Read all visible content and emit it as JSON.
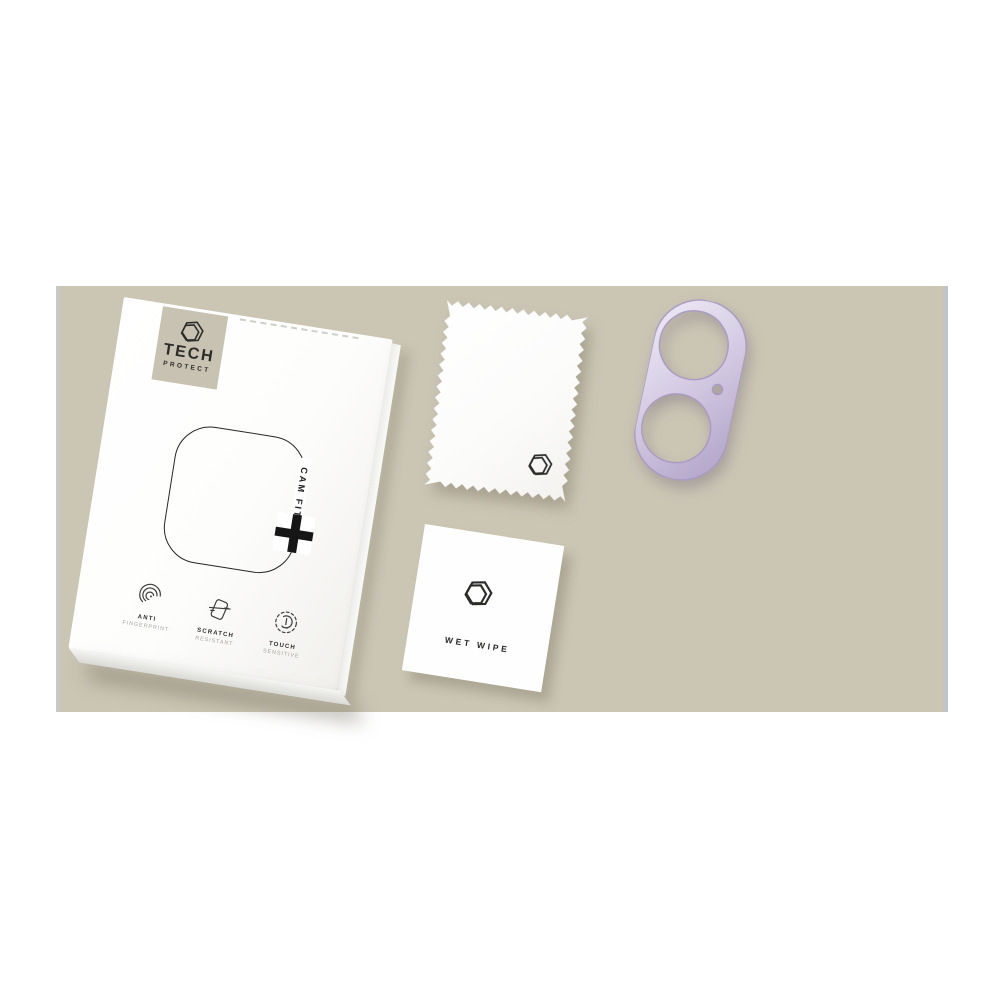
{
  "scene": {
    "page_background": "#ffffff",
    "photo_background": "#cbc5b4",
    "photo_edge_strip": "#c3c4c6"
  },
  "box": {
    "brand_line1": "TECH",
    "brand_line2": "PROTECT",
    "product_label": "CAM FIT",
    "features": [
      {
        "title": "ANTI",
        "subtitle": "FINGERPRINT",
        "icon": "fingerprint-icon"
      },
      {
        "title": "SCRATCH",
        "subtitle": "RESISTANT",
        "icon": "scratch-icon"
      },
      {
        "title": "TOUCH",
        "subtitle": "SENSITIVE",
        "icon": "touch-icon"
      }
    ]
  },
  "cloth": {
    "logo_icon": "hexagon-logo-icon"
  },
  "wipe": {
    "label": "WET WIPE",
    "logo_icon": "hexagon-logo-icon"
  },
  "protector": {
    "body_color": "#d5cce3",
    "edge_color": "#a89bc3",
    "large_holes": 2,
    "small_holes": 1
  }
}
